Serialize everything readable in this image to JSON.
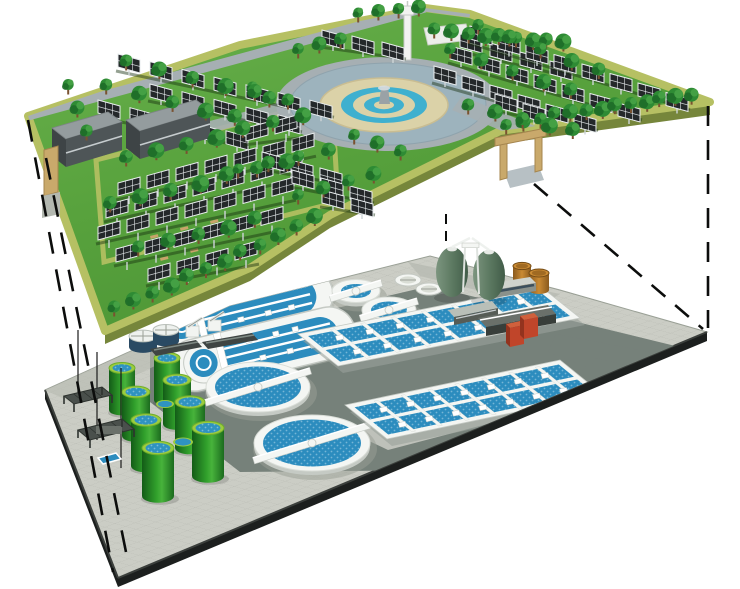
{
  "scene": {
    "type": "isometric-cutaway-illustration",
    "description": "Two-level cutaway rendering: a landscaped solar park with trees and a central fountain plaza on the surface level, above an underground wastewater treatment plant; dashed projection lines connect the corners of the two levels.",
    "upper_level": {
      "name": "solar-park-surface-level",
      "features": [
        {
          "name": "solar-panel-array",
          "rows": 18,
          "panel_count_approx": 88
        },
        {
          "name": "trees",
          "count_approx": 100
        },
        {
          "name": "central-fountain-plaza",
          "rings": [
            "pond",
            "paved-ring",
            "water-ring",
            "paved-ring",
            "fountain"
          ]
        },
        {
          "name": "observation-tower",
          "count": 1
        },
        {
          "name": "office-buildings",
          "count": 2
        },
        {
          "name": "entrance-gates",
          "count": 2
        }
      ]
    },
    "lower_level": {
      "name": "underground-wastewater-treatment-plant",
      "features": [
        {
          "name": "oxidation-ditches",
          "count": 2
        },
        {
          "name": "secondary-clarifiers-large",
          "count": 2
        },
        {
          "name": "clarifiers-medium",
          "count": 2
        },
        {
          "name": "covered-tanks-small",
          "count": 2
        },
        {
          "name": "aeration-basins",
          "count": 2
        },
        {
          "name": "sludge-digester-eggs",
          "count": 2
        },
        {
          "name": "green-storage-tanks",
          "count": 8
        },
        {
          "name": "storage-drums",
          "count": 2
        },
        {
          "name": "service-buildings",
          "count": 4
        },
        {
          "name": "red-pump-house",
          "count": 1
        },
        {
          "name": "inlet-equipment-units",
          "count": 4
        },
        {
          "name": "filter-pergolas",
          "count": 2
        }
      ]
    },
    "connectors": {
      "name": "projection-lines",
      "style": "dashed",
      "count": 5
    }
  },
  "palette": {
    "bg": "#ffffff",
    "grass": "#58a23d",
    "grassDeep": "#4a9334",
    "grassLight": "#69b14c",
    "border": "#b6c063",
    "wallOlive": "#76863b",
    "wallGray": "#a9af9f",
    "panel": "#24282a",
    "panelFrame": "#e9edef",
    "post": "#ced5d7",
    "rowShadow": "#17300f",
    "treeMain": "#2e8b34",
    "treeDark": "#1e6b28",
    "treeLight": "#47a246",
    "trunk": "#7a5230",
    "road": "#a6afb3",
    "pond": "#9db3bd",
    "plazaTan": "#dbd2a8",
    "plazaBlue": "#3fb0cf",
    "fountainGray": "#9aa2a6",
    "towerWhite": "#f2f3f1",
    "towerShade": "#c6cac6",
    "bldTop": "#949c9e",
    "bldFront": "#4e5557",
    "bldSide": "#3e4446",
    "bldStripe": "#c6ccce",
    "gateTan": "#c9a96b",
    "gateShade": "#a5854e",
    "tile": "#cbcdc5",
    "tileShade": "#b7bab1",
    "pad": "#76817a",
    "padDark": "#5f6a64",
    "edgeBlack": "#1c1f1e",
    "rim": "#f4f6f3",
    "rimShade": "#c5cac4",
    "waterBlue": "#2c8cbe",
    "waterDeep": "#1f6f9d",
    "dotBlue": "#cfe9f5",
    "tankG1": "#135c17",
    "tankG2": "#31a02c",
    "tankG3": "#47b33b",
    "tankG4": "#1b6b1e",
    "tankRim": "#9ccc3f",
    "tankTop": "#2f93c0",
    "navy": "#2a4a63",
    "egg1": "#7c957f",
    "egg2": "#5d7a62",
    "egg3": "#415c48",
    "drum1": "#c98a33",
    "drum2": "#8a5a1e",
    "red": "#c0452a",
    "redDark": "#93331e",
    "redLight": "#d0603c",
    "grayEquip": "#4a504c",
    "grayEquip2": "#6a706a",
    "dash": "#0c0d0c"
  }
}
